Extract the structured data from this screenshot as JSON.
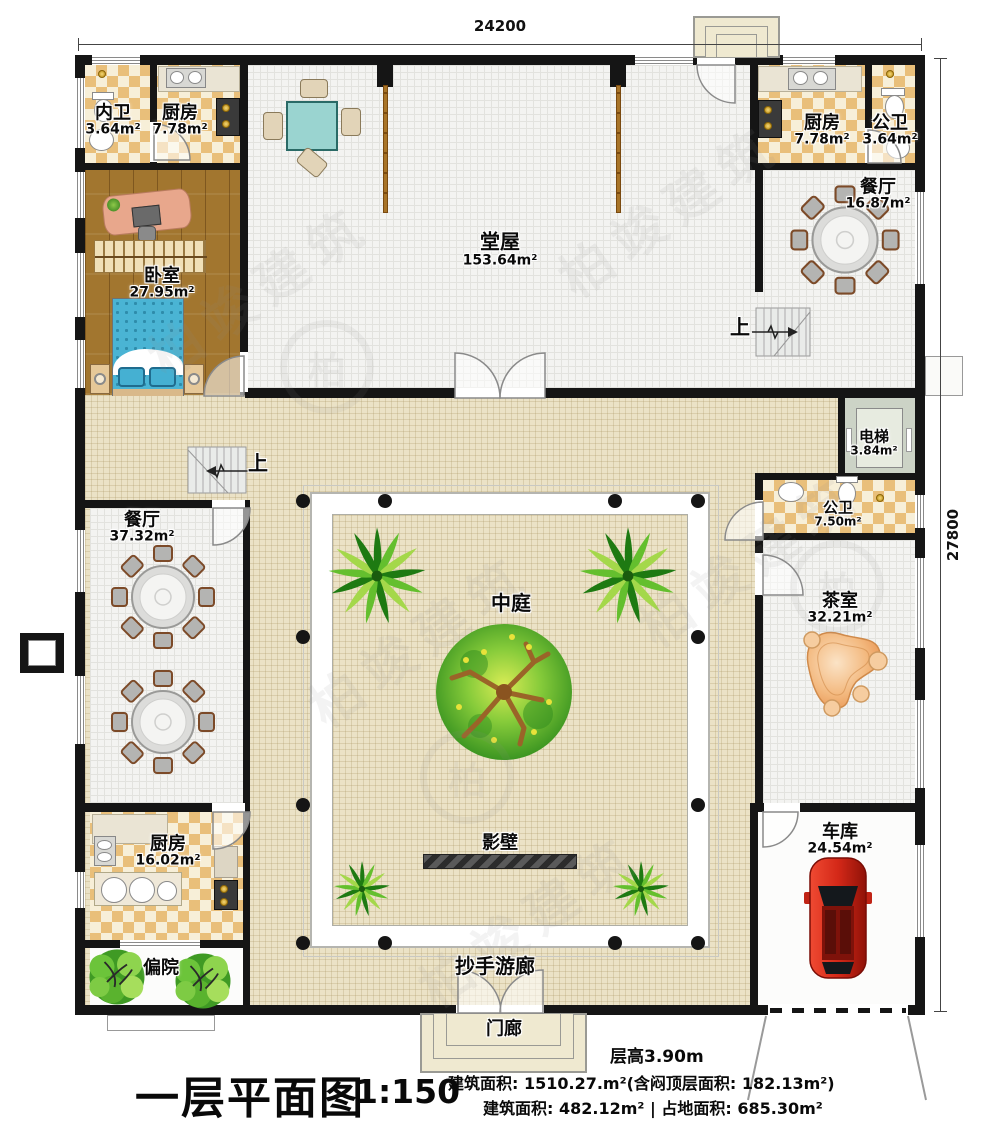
{
  "watermark": {
    "text": "柏竣建筑"
  },
  "dimensions": {
    "top": "24200",
    "right": "27800"
  },
  "stairs": {
    "up": "上"
  },
  "rooms": {
    "neiwei": {
      "name": "内卫",
      "area": "3.64m²"
    },
    "kitchen_tl": {
      "name": "厨房",
      "area": "7.78m²"
    },
    "tangwu": {
      "name": "堂屋",
      "area": "153.64m²"
    },
    "kitchen_tr": {
      "name": "厨房",
      "area": "7.78m²"
    },
    "gongwei_tr": {
      "name": "公卫",
      "area": "3.64m²"
    },
    "dining_tr": {
      "name": "餐厅",
      "area": "16.87m²"
    },
    "bedroom": {
      "name": "卧室",
      "area": "27.95m²"
    },
    "elevator": {
      "name": "电梯",
      "area": "3.84m²"
    },
    "gongwei_mid": {
      "name": "公卫",
      "area": "7.50m²"
    },
    "dining_left": {
      "name": "餐厅",
      "area": "37.32m²"
    },
    "courtyard": {
      "name": "中庭"
    },
    "tea_room": {
      "name": "茶室",
      "area": "32.21m²"
    },
    "kitchen_bl": {
      "name": "厨房",
      "area": "16.02m²"
    },
    "screen_wall": {
      "name": "影壁"
    },
    "garage": {
      "name": "车库",
      "area": "24.54m²"
    },
    "side_yard": {
      "name": "偏院"
    },
    "veranda": {
      "name": "抄手游廊"
    },
    "porch": {
      "name": "门廊"
    }
  },
  "footer": {
    "title": "一层平面图",
    "scale": "1:150",
    "floor_height": "层高3.90m",
    "area_line1": "建筑面积: 1510.27.m²(含闷顶层面积: 182.13m²)",
    "area_line2a": "建筑面积: 482.12m²",
    "area_line2_sep": "|",
    "area_line2b": "占地面积: 685.30m²"
  },
  "colors": {
    "wall": "#151515",
    "floor_beige": "#ebe2c6",
    "checker_tan": "#e9bf7a",
    "wood": "#a2762f",
    "bed_blue": "#4ab4d4",
    "car_red": "#d42818",
    "tree_green": "#4aa32a"
  }
}
